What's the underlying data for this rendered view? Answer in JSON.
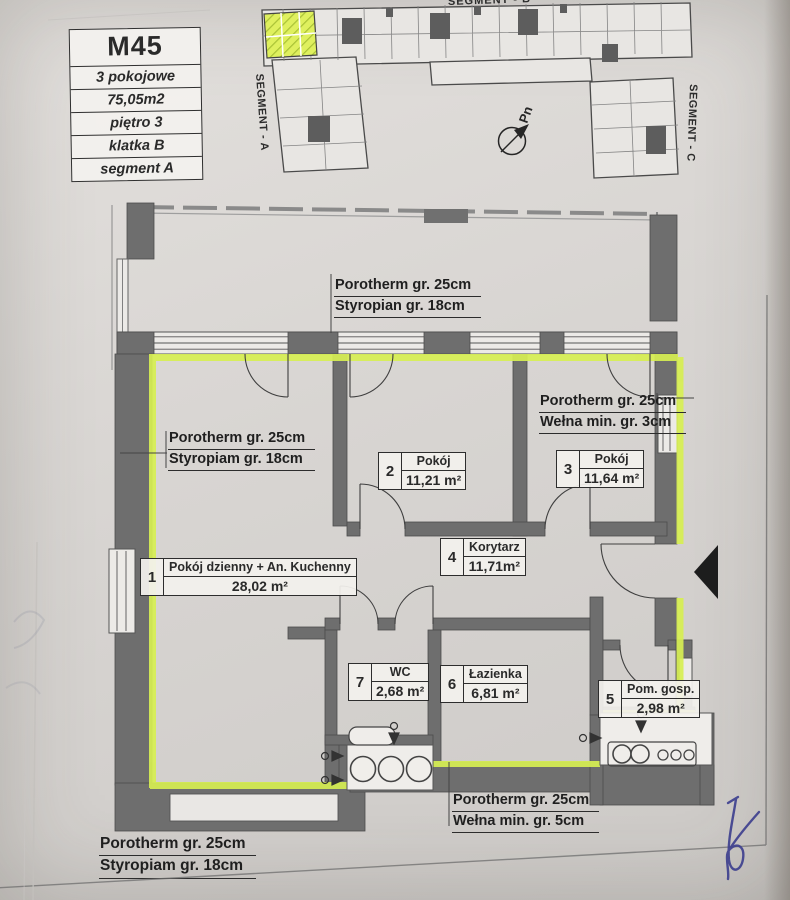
{
  "info_card": {
    "id": "M45",
    "rows": [
      "3 pokojowe",
      "75,05m2",
      "piętro 3",
      "klatka B",
      "segment A"
    ]
  },
  "overview": {
    "segment_a": "SEGMENT - A",
    "segment_b": "SEGMENT - B",
    "segment_c": "SEGMENT - C",
    "north_label": "Pn"
  },
  "rooms": [
    {
      "no": "1",
      "name": "Pokój dzienny + An. Kuchenny",
      "area": "28,02 m²"
    },
    {
      "no": "2",
      "name": "Pokój",
      "area": "11,21 m²"
    },
    {
      "no": "3",
      "name": "Pokój",
      "area": "11,64 m²"
    },
    {
      "no": "4",
      "name": "Korytarz",
      "area": "11,71m²"
    },
    {
      "no": "5",
      "name": "Pom. gosp.",
      "area": "2,98 m²"
    },
    {
      "no": "6",
      "name": "Łazienka",
      "area": "6,81 m²"
    },
    {
      "no": "7",
      "name": "WC",
      "area": "2,68 m²"
    }
  ],
  "wall_labels": {
    "top": [
      "Porotherm gr. 25cm",
      "Styropian gr. 18cm"
    ],
    "left": [
      "Porotherm gr. 25cm",
      "Styropiam gr. 18cm"
    ],
    "right": [
      "Porotherm gr. 25cm",
      "Wełna min. gr. 3cm"
    ],
    "bottom": [
      "Porotherm gr. 25cm",
      "Wełna min. gr. 5cm"
    ],
    "bottom_left": [
      "Porotherm gr. 25cm",
      "Styropiam gr. 18cm"
    ]
  },
  "colors": {
    "highlight": "#d7ef52",
    "wall": "#6e6e6e",
    "ink": "#2a2a2a",
    "pen_blue": "#3c3e8e",
    "paper": "#d9d6d3"
  }
}
